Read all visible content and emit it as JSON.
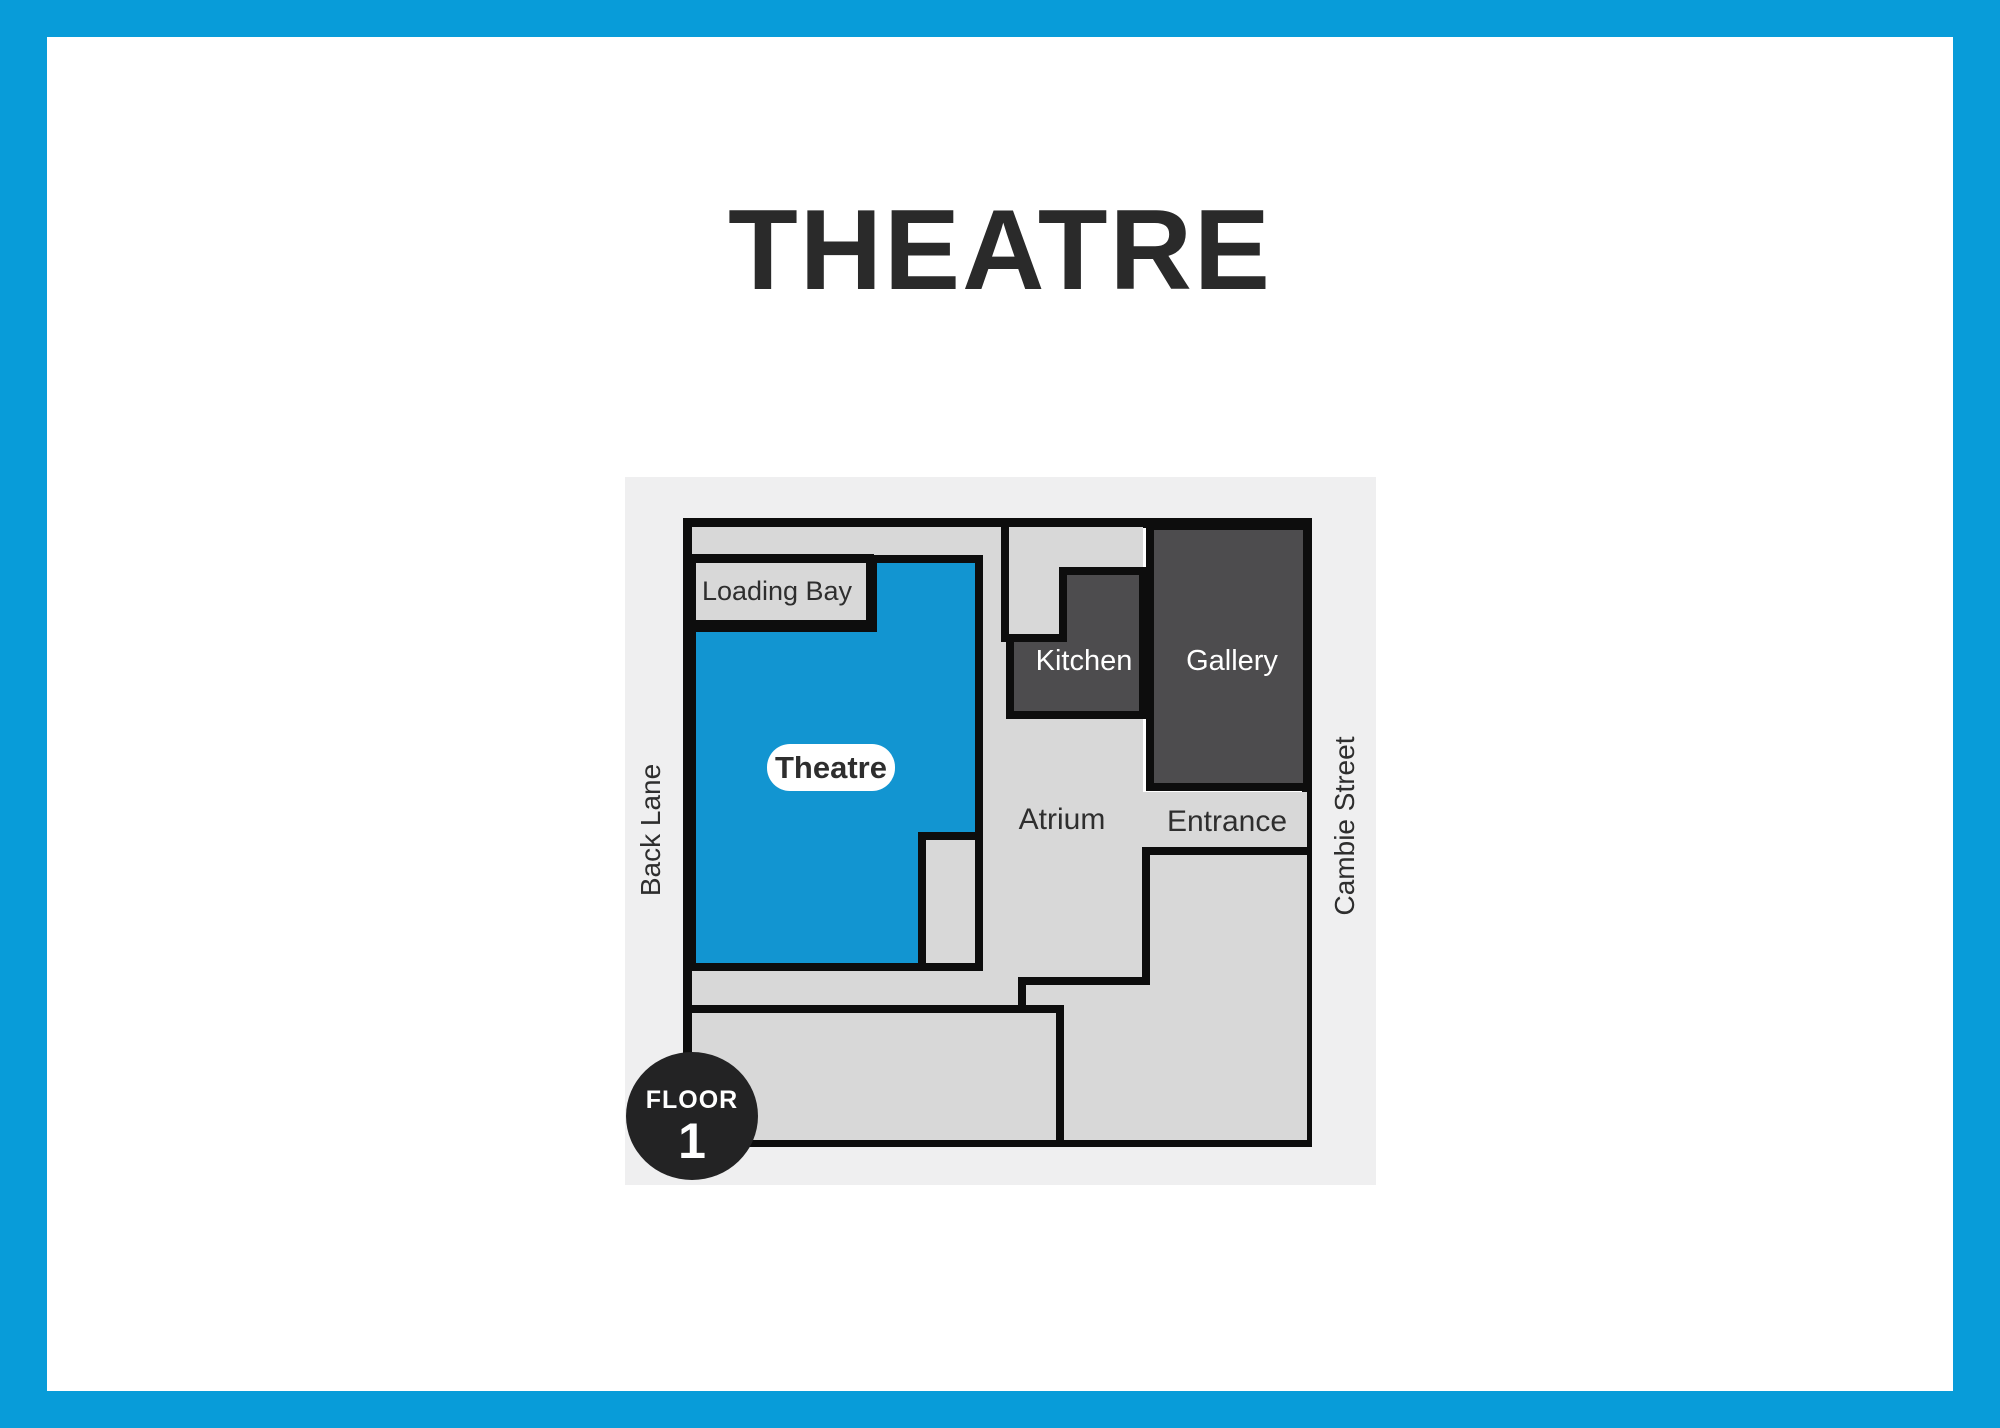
{
  "title": "THEATRE",
  "floor_plan": {
    "rooms": {
      "loading_bay": "Loading Bay",
      "theatre": "Theatre",
      "kitchen": "Kitchen",
      "gallery": "Gallery",
      "atrium": "Atrium",
      "entrance": "Entrance"
    },
    "streets": {
      "left": "Back Lane",
      "right": "Cambie Street"
    },
    "badge": {
      "line1": "FLOOR",
      "line2": "1"
    }
  },
  "colors": {
    "frame_blue": "#089cd9",
    "theatre_blue": "#1295d1",
    "room_light": "#d8d8d8",
    "room_dark": "#4d4c4e",
    "wall": "#0d0d0d",
    "panel_bg": "#efeff0",
    "page_bg": "#ffffff",
    "badge_bg": "#232324",
    "title_text": "#2a2a2a",
    "label_dark": "#2e2e2e",
    "label_light": "#ffffff"
  }
}
